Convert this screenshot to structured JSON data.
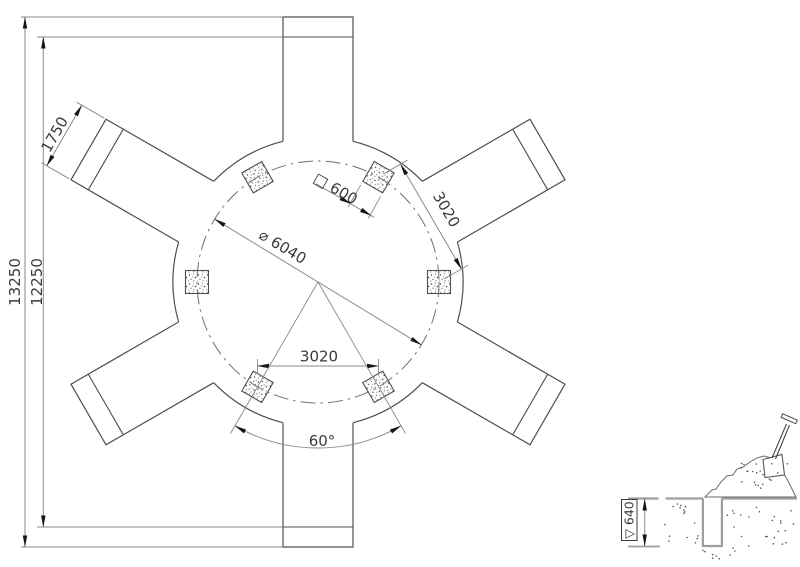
{
  "colors": {
    "background": "#ffffff",
    "line": "#4f4f4f",
    "centerline": "#6e6e6e",
    "dim": "#8a8a8a",
    "arrow": "#161616",
    "text": "#3a3a3a",
    "ground": "#9e9e9e"
  },
  "plan": {
    "dim_total_height": "13250",
    "dim_inner_height": "12250",
    "dim_arm_width": "1750",
    "dim_footing_size": "□ 600",
    "dim_pitch_diameter": "⌀ 6040",
    "dim_footing_spacing_chord": "3020",
    "dim_footing_spacing_bottom": "3020",
    "dim_angle_between_footings": "60°"
  },
  "detail": {
    "dim_excavation_depth": "▽ 640"
  }
}
